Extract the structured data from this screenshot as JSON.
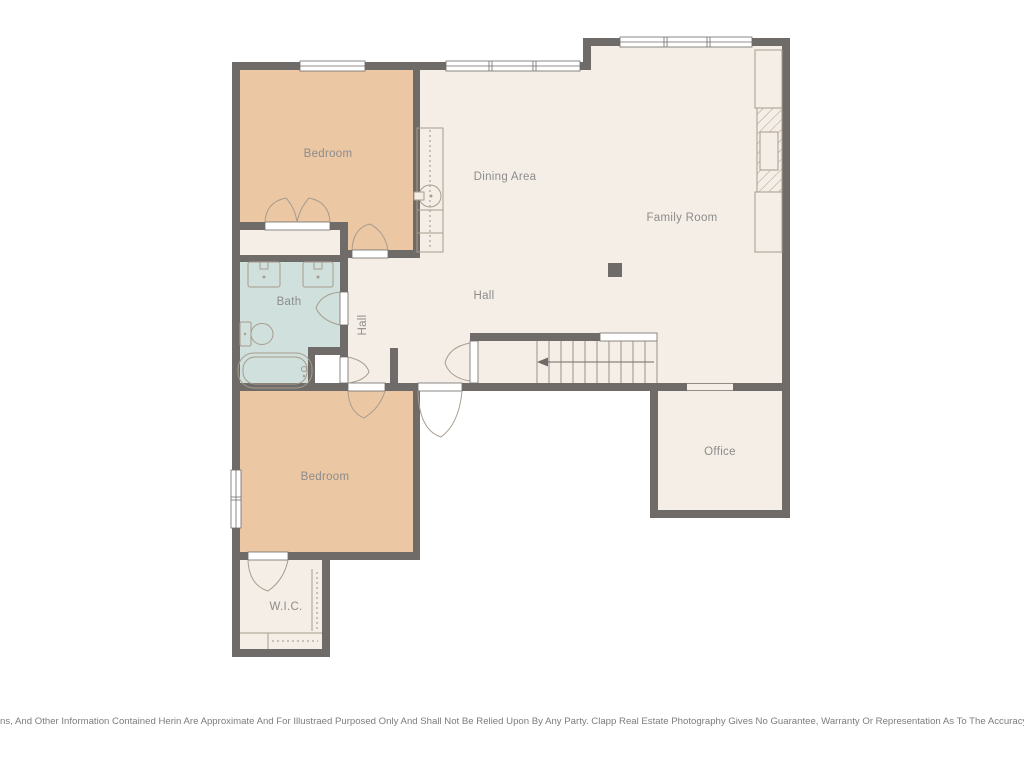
{
  "rooms": {
    "bedroom_top": {
      "label": "Bedroom"
    },
    "dining": {
      "label": "Dining Area"
    },
    "family": {
      "label": "Family Room"
    },
    "hall_corridor": {
      "label": "Hall"
    },
    "hall_main": {
      "label": "Hall"
    },
    "bath": {
      "label": "Bath"
    },
    "office": {
      "label": "Office"
    },
    "bedroom_bottom": {
      "label": "Bedroom"
    },
    "wic": {
      "label": "W.I.C."
    }
  },
  "colors": {
    "wall": "#6f6b68",
    "bedroom": "#ebc7a3",
    "cream": "#f5eee6",
    "bath": "#cfe0dd",
    "white": "#ffffff",
    "label_text": "#8c8c8c",
    "fixture_line": "#a89c8e"
  },
  "footer": {
    "disclaimer": "All Images, Dimensions, And Other Information Contained Herin Are Approximate And For Illustraed Purposed Only And Shall Not Be Relied Upon By Any Party. Clapp Real Estate Photography Gives No Guarantee, Warranty Or Representation As To The Accuracy Of This Information."
  }
}
